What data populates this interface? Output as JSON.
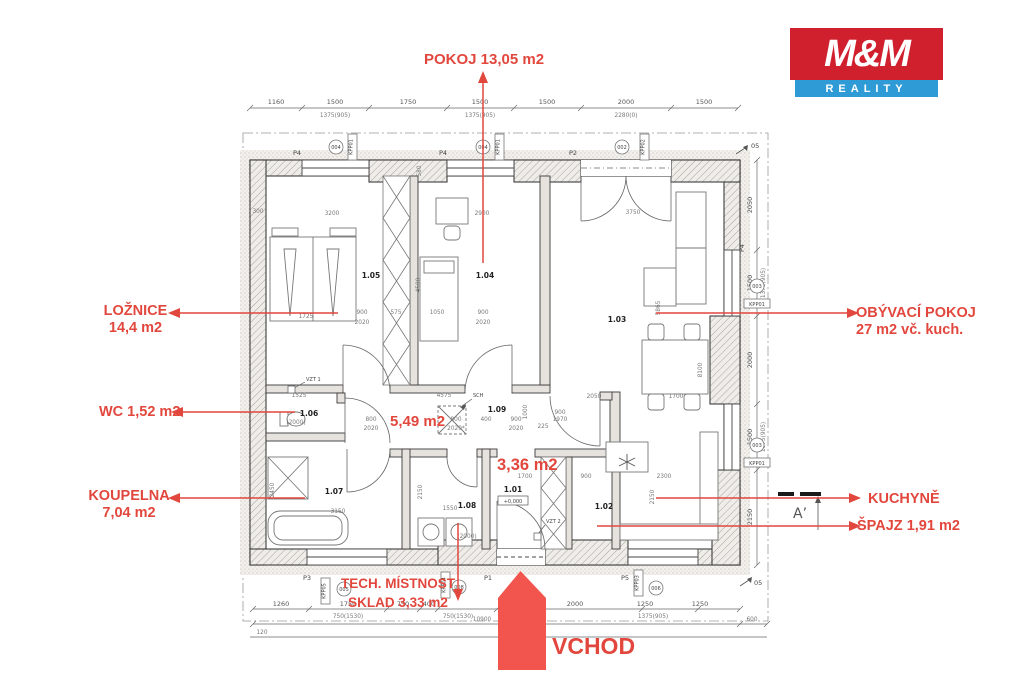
{
  "logo": {
    "line1": "M&M",
    "line2": "REALITY"
  },
  "colors": {
    "label_red": "#e2473d",
    "arrow_red": "#f1554d",
    "logo_red": "#d0202e",
    "logo_blue": "#2e9bd6"
  },
  "labels": {
    "pokoj": "POKOJ 13,05 m2",
    "loznice_1": "LOŽNICE",
    "loznice_2": "14,4 m2",
    "wc": "WC 1,52 m2",
    "koupelna_1": "KOUPELNA",
    "koupelna_2": "7,04 m2",
    "obyvaci_1": "OBÝVACÍ POKOJ",
    "obyvaci_2": "27 m2  vč. kuch.",
    "kuchyne": "KUCHYNĚ",
    "spajz": "ŠPAJZ  1,91 m2",
    "tech_1": "TECH. MÍSTNOST",
    "tech_2": "SKLAD 3,33 m2",
    "vchod": "VCHOD",
    "hala": "5,49 m2",
    "zadveri": "3,36 m2"
  },
  "plan": {
    "rooms": {
      "r101": "1.01",
      "r102": "1.02",
      "r103": "1.03",
      "r104": "1.04",
      "r105": "1.05",
      "r106": "1.06",
      "r107": "1.07",
      "r108": "1.08",
      "r109": "1.09"
    },
    "elevation": "+0,000",
    "dims_top": [
      "1160",
      "1500",
      "1750",
      "1500",
      "1500",
      "2000",
      "1500"
    ],
    "dims_top_sub": [
      "1375(905)",
      "1375(905)",
      "2280(0)"
    ],
    "dims_bottom": [
      "1260",
      "1750",
      "750",
      "400",
      "2000",
      "1250",
      "1250"
    ],
    "dims_bottom_sub": [
      "750(1530)",
      "750(1530)",
      "1375(905)"
    ],
    "dims_bottom_total": "10900",
    "dims_bottom_right": "600",
    "dims_bottom_left": "120",
    "dims_right": [
      "2050",
      "1500",
      "2000",
      "1500",
      "2150"
    ],
    "dims_right_sub": [
      "1375(905)",
      "1375(905)"
    ],
    "interior_dims": [
      "3200",
      "2900",
      "3750",
      "1725",
      "900",
      "2020",
      "575",
      "1050",
      "900",
      "2020",
      "4500",
      "5865",
      "8100",
      "4575",
      "2050",
      "800",
      "2020",
      "800",
      "2020*",
      "400",
      "900",
      "2020",
      "1525",
      "(2000)",
      "3150",
      "2450",
      "1550",
      "2150",
      "1700",
      "900",
      "2300",
      "2150",
      "1700",
      "225",
      "900",
      "1970",
      "(2000)",
      "1000",
      "580",
      "300"
    ],
    "markers": {
      "p4a": "P4",
      "p4b": "P4",
      "p2": "P2",
      "p4r": "P4",
      "p3": "P3",
      "p1": "P1",
      "p5": "P5",
      "c004a": "004",
      "c004b": "004",
      "c002": "002",
      "c003a": "003",
      "c003b": "003",
      "c005": "005",
      "c008": "008",
      "c006": "006",
      "kpp01a": "KPP01",
      "kpp01b": "KPP01",
      "kpp02": "KPP02",
      "kpp01c": "KPP01",
      "kpp01d": "KPP01",
      "kpp05": "KPP05",
      "kpp04": "KPP04",
      "kpp03": "KPP03",
      "vzt1": "VZT 1",
      "vzt2": "VZT 2",
      "sch": "SCH",
      "a_prime": "A’",
      "o5a": "05",
      "o5b": "05"
    }
  }
}
